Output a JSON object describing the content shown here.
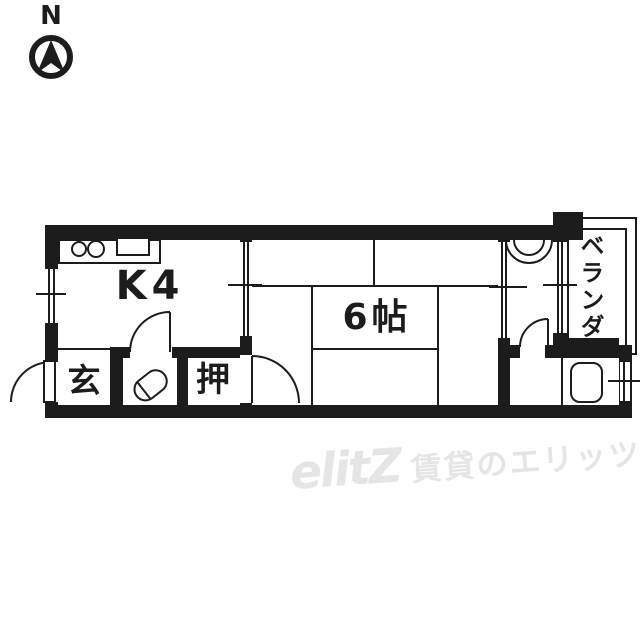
{
  "compass": {
    "label": "N"
  },
  "floorplan": {
    "rooms": {
      "kitchen": {
        "label": "K4"
      },
      "main_room": {
        "label": "6帖"
      },
      "entrance": {
        "label": "玄"
      },
      "closet": {
        "label": "押"
      },
      "veranda": {
        "label": "ベランダ"
      }
    },
    "fixtures": [
      "stove-burners",
      "kitchen-sink",
      "toilet",
      "washbasin",
      "bathtub"
    ]
  },
  "watermark": {
    "logo": "elitZ",
    "text": "賃貸のエリッツ"
  },
  "colors": {
    "line": "#1c1c1c",
    "watermark": "#e5e5e5",
    "background": "#ffffff"
  }
}
